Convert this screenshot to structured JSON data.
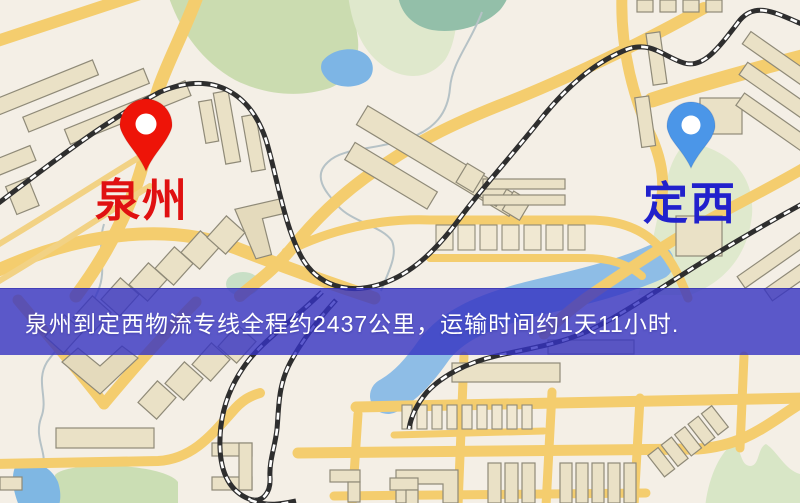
{
  "map": {
    "origin": {
      "name": "泉州",
      "pin_icon": "red-location-pin",
      "pin_color": "#ee1408",
      "label_color": "#e01111"
    },
    "destination": {
      "name": "定西",
      "pin_icon": "blue-location-pin",
      "pin_color": "#4b96e8",
      "label_color": "#2121cc"
    },
    "banner": {
      "text": "泉州到定西物流专线全程约2437公里，运输时间约1天11小时.",
      "distance": "约2437公里",
      "duration": "约1天11小时",
      "background_color": "rgba(53,50,194,0.8)",
      "text_color": "#ffffff"
    },
    "map_colors": {
      "background": "#f4efe6",
      "road": "#f4cd6e",
      "park_green": "#cbdcb0",
      "water_blue": "#7fb7e3",
      "building": "#eae1c6",
      "railway": "#2e2e2e"
    }
  }
}
